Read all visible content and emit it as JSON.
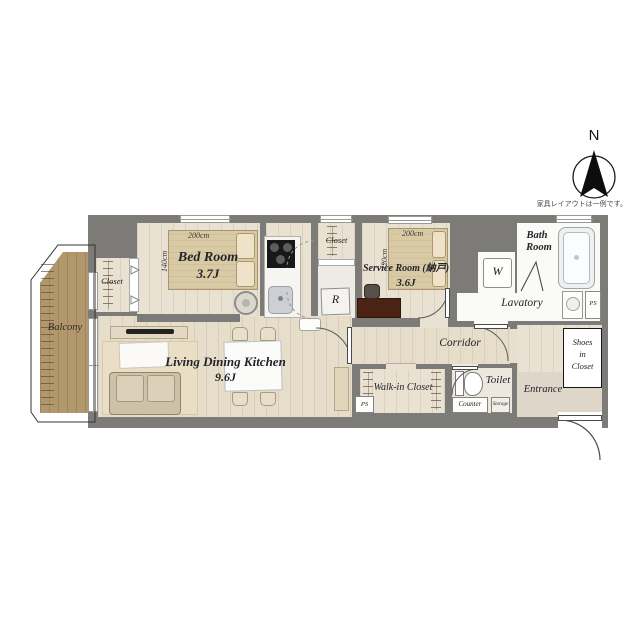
{
  "meta": {
    "north_label": "N",
    "disclaimer": "家具レイアウトは一例です。"
  },
  "colors": {
    "wall": "#7d7b78",
    "wood_floor": "#e9e1d2",
    "wet_floor": "#fafaf7",
    "balcony": "#b2966c",
    "bed": "#d9caa6",
    "desk_dark": "#4b2315",
    "label_text": "#23232b"
  },
  "rooms": {
    "bedroom": {
      "name": "Bed Room",
      "size": "3.7J",
      "bed_width": "200cm",
      "bed_depth": "140cm"
    },
    "service_room": {
      "name": "Service Room (納戸)",
      "size": "3.6J",
      "bed_width": "200cm",
      "bed_depth": "120cm"
    },
    "ldk": {
      "name": "Living Dining Kitchen",
      "size": "9.6J"
    },
    "bath": {
      "line1": "Bath",
      "line2": "Room"
    },
    "lavatory": {
      "name": "Lavatory"
    },
    "corridor": {
      "name": "Corridor"
    },
    "walk_in_closet": {
      "name": "Walk-in Closet"
    },
    "toilet": {
      "name": "Toilet"
    },
    "entrance": {
      "name": "Entrance"
    },
    "balcony": {
      "name": "Balcony"
    },
    "closet_left": {
      "name": "Closet"
    },
    "closet_mid": {
      "name": "Closet"
    },
    "shoes_closet": {
      "line1": "Shoes",
      "line2": "in",
      "line3": "Closet"
    },
    "washer": {
      "label": "W"
    },
    "refrigerator": {
      "label": "R"
    },
    "ps_left": {
      "label": "PS"
    },
    "ps_right": {
      "label": "PS"
    },
    "counter": {
      "label": "Counter"
    },
    "storage": {
      "label": "Storage"
    }
  }
}
